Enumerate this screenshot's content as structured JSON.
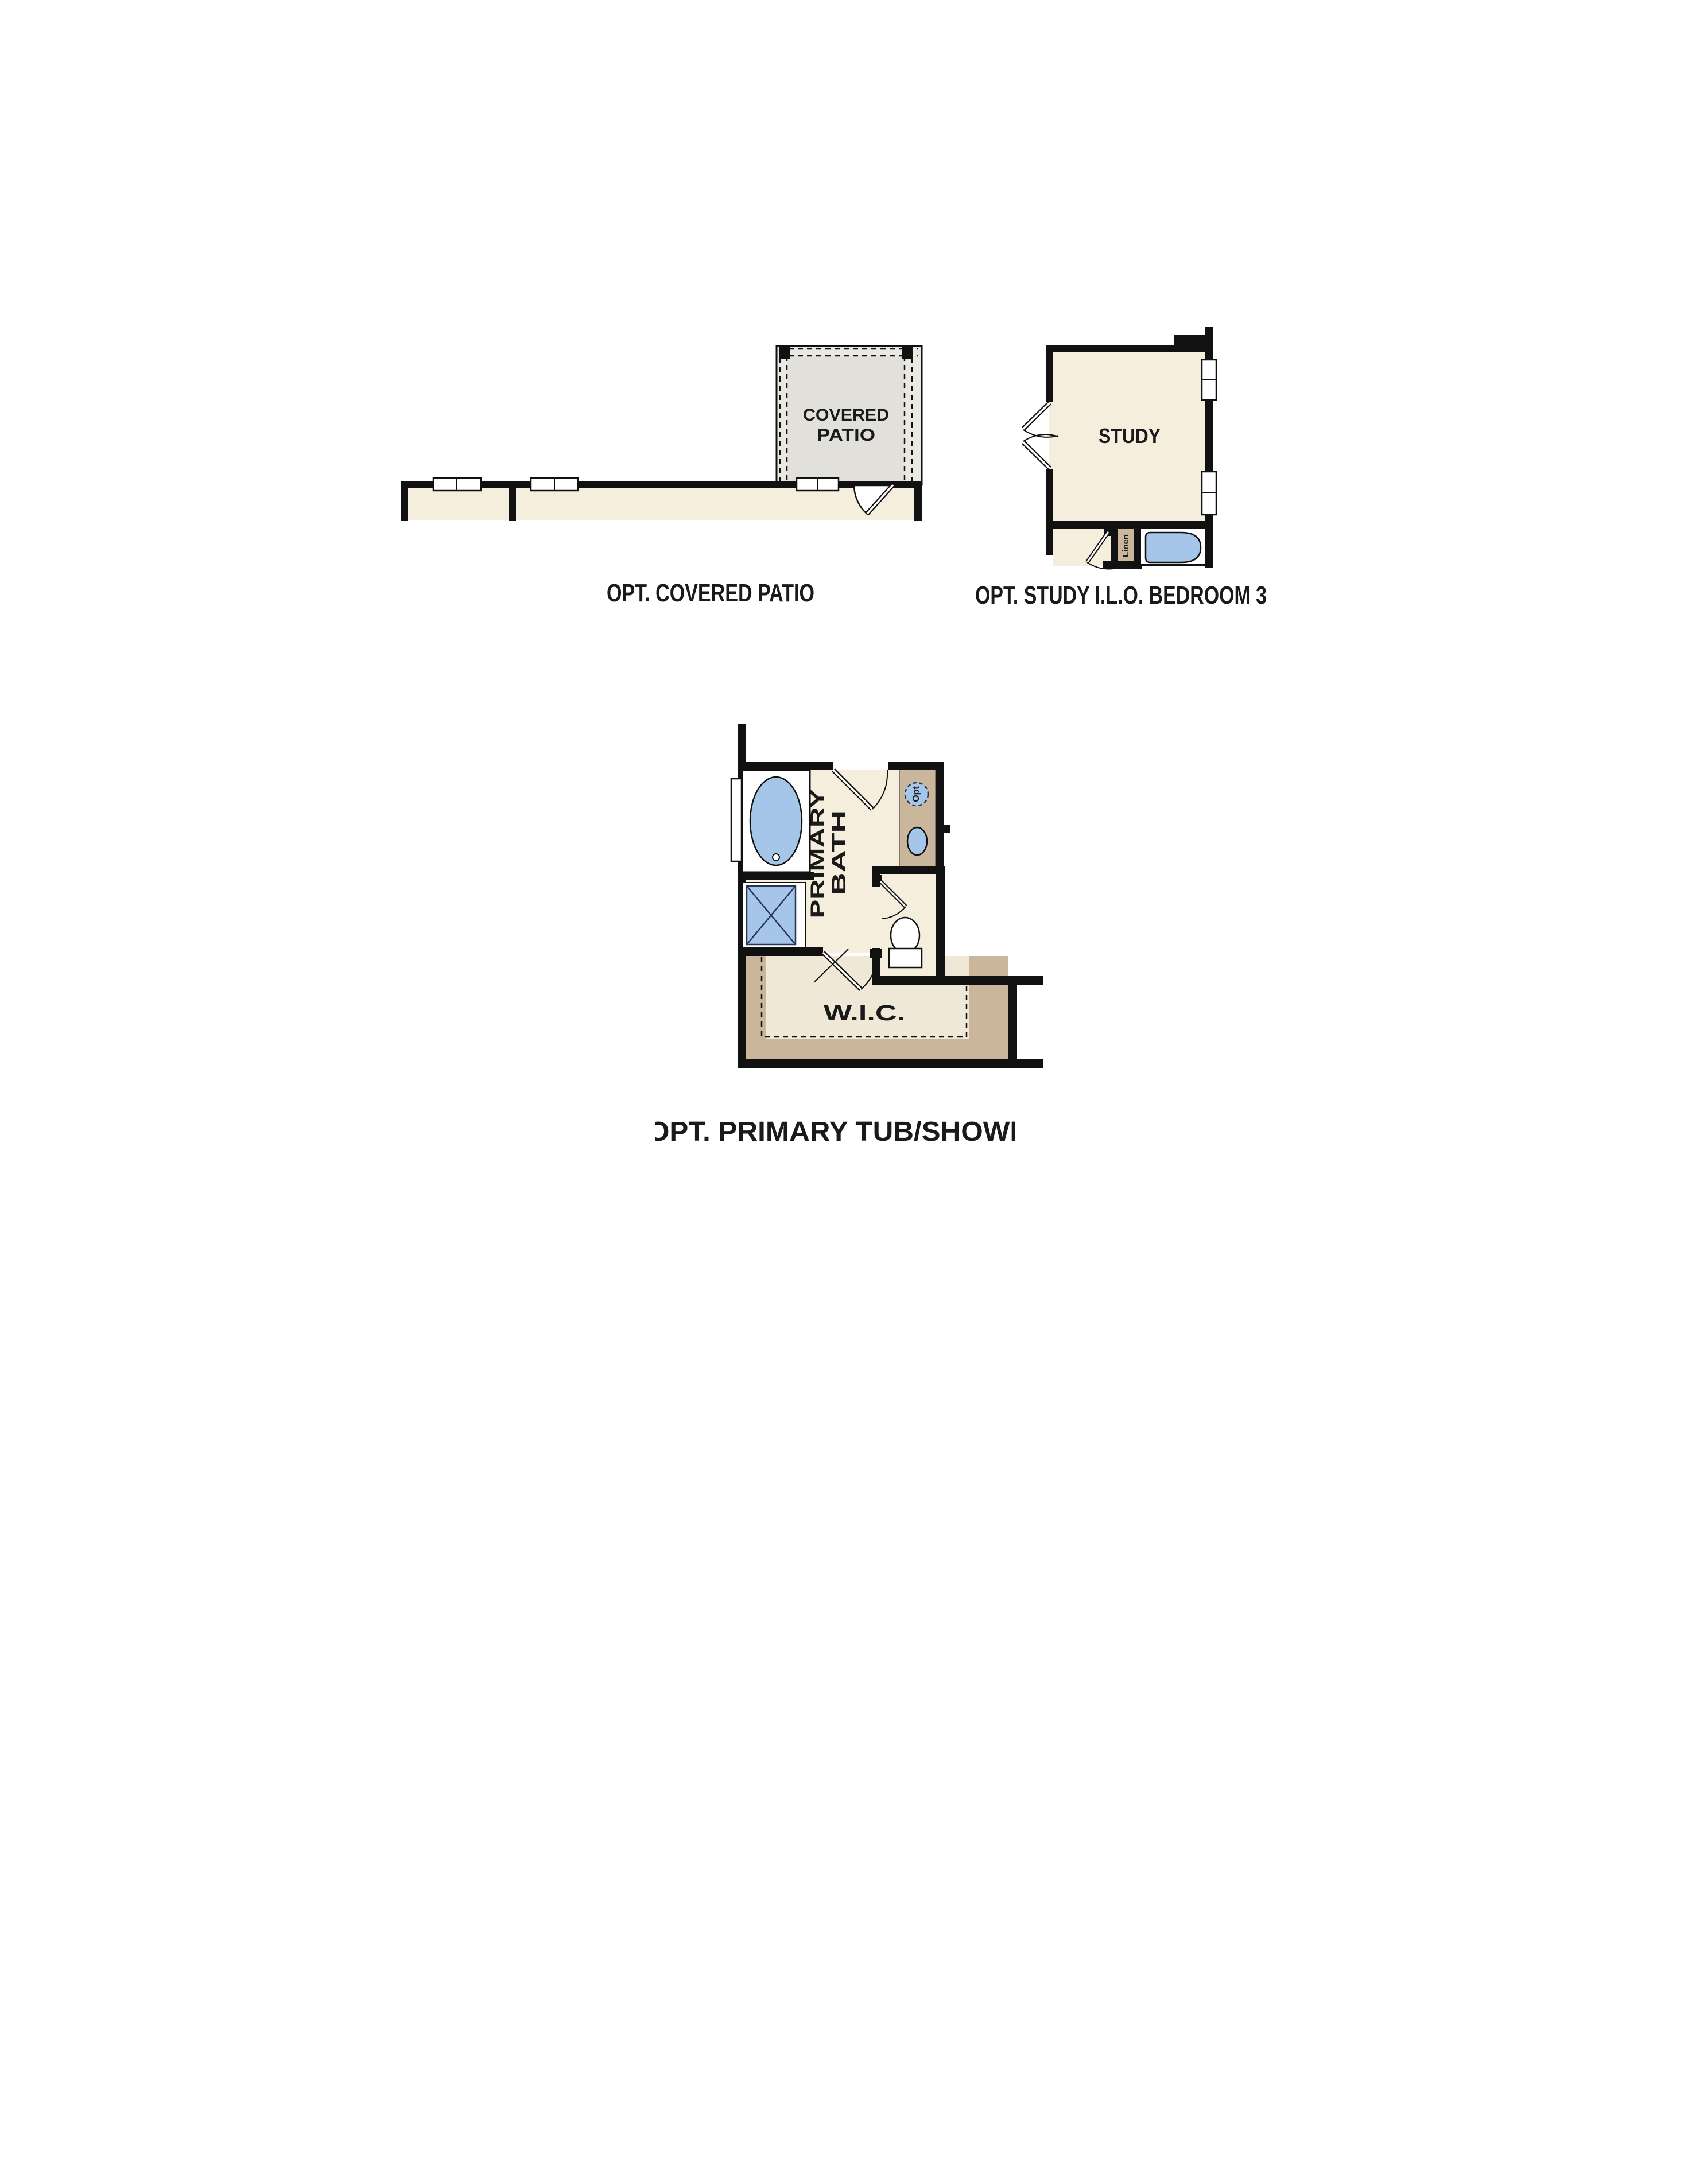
{
  "page": {
    "type": "floor-plan-options-sheet",
    "background": "#ffffff"
  },
  "colors": {
    "wall": "#111111",
    "room_fill": "#f5eedd",
    "patio_fill": "#e2e0da",
    "patio_edge_fill": "#eae8e3",
    "tan_fill": "#c9b69b",
    "wic_interior_fill": "#f0e8d6",
    "fixture_blue": "#a5c6e9",
    "fixture_outline": "#263553",
    "text": "#1a1a1a"
  },
  "diagrams": {
    "covered_patio": {
      "room_label_line1": "COVERED",
      "room_label_line2": "PATIO",
      "caption": "OPT. COVERED PATIO"
    },
    "study": {
      "room_label": "STUDY",
      "closet_label": "Linen",
      "caption": "OPT. STUDY I.L.O. BEDROOM 3"
    },
    "primary_bath": {
      "room_label_line1": "PRIMARY",
      "room_label_line2": "BATH",
      "wic_label": "W.I.C.",
      "optional_fixture_label": "Opt",
      "caption": "OPT. PRIMARY TUB/SHOWER"
    }
  }
}
